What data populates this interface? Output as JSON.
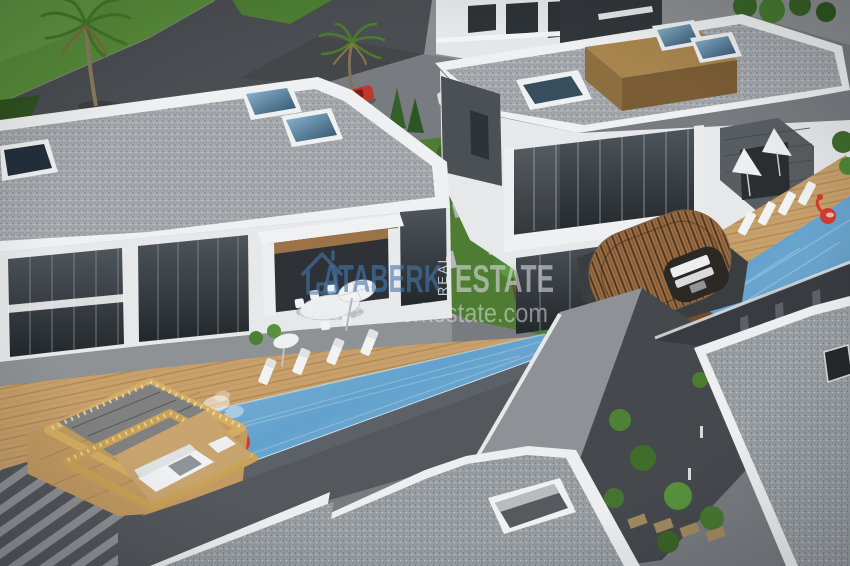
{
  "watermark": {
    "logo": "house-outline-icon",
    "brand_first": "ATABERK",
    "brand_vertical": "REAL",
    "brand_second": "ESTATE",
    "website": "www.ataberkestate.com",
    "brand_blue": "#4678ad",
    "brand_light": "#d9dcdf",
    "website_color": "#e8eaec"
  },
  "scene": {
    "colors": {
      "grass": "#578b39",
      "garden": "#4f7c33",
      "road": "#4a4d51",
      "pool_water": "#5b9dcb",
      "roof_speckle": "#a6aaae",
      "fascia_white": "#eff0f1",
      "deck_wood": "#c7a06c",
      "pergola_wood": "#d4ad62",
      "barrel_wood": "#9c6d41",
      "glass_dark": "#2f353b",
      "float_red": "#d43a31",
      "foliage": "#4a7d31"
    }
  }
}
